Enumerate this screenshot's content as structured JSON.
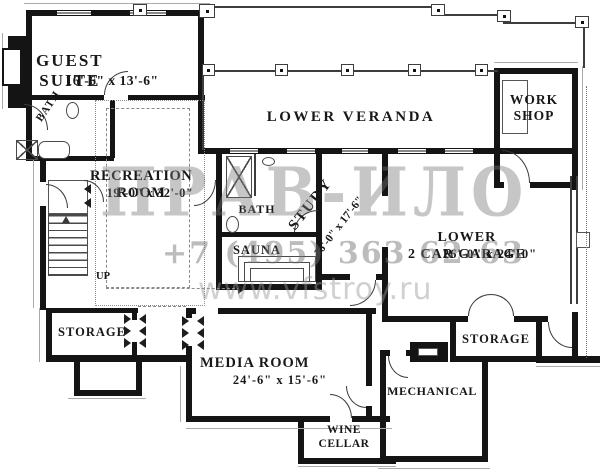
{
  "rooms": {
    "guest_suite": {
      "name": "GUEST\nSUITE",
      "dims": "16'-6\" x 13'-6\""
    },
    "guest_bath": {
      "name": "BATH"
    },
    "recreation": {
      "name": "RECREATION\nROOM",
      "dims": "19'-0\" x 32'-0\""
    },
    "veranda": {
      "name": "LOWER VERANDA"
    },
    "workshop": {
      "name": "WORK\nSHOP"
    },
    "bath": {
      "name": "BATH"
    },
    "sauna": {
      "name": "SAUNA"
    },
    "study": {
      "name": "STUDY",
      "dims": "16'-0\" x 17'-6\""
    },
    "garage": {
      "name": "LOWER\n2 CAR GARAGE",
      "dims": "26'-0\" x 24'-0\""
    },
    "stairs": {
      "label": "UP"
    },
    "storage_left": {
      "name": "STORAGE"
    },
    "media": {
      "name": "MEDIA ROOM",
      "dims": "24'-6\" x 15'-6\""
    },
    "mechanical": {
      "name": "MECHANICAL"
    },
    "storage_right": {
      "name": "STORAGE"
    },
    "wine_cellar": {
      "name": "WINE\nCELLAR"
    }
  },
  "watermark": {
    "logo": "ПРАВ-ИЛО",
    "phone": "+7 (495) 363 62-63",
    "website": "www.vfstroy.ru"
  },
  "colors": {
    "wall": "#141414",
    "thin_line": "#3d3d3d",
    "watermark_gray": "#9a9a9a"
  }
}
